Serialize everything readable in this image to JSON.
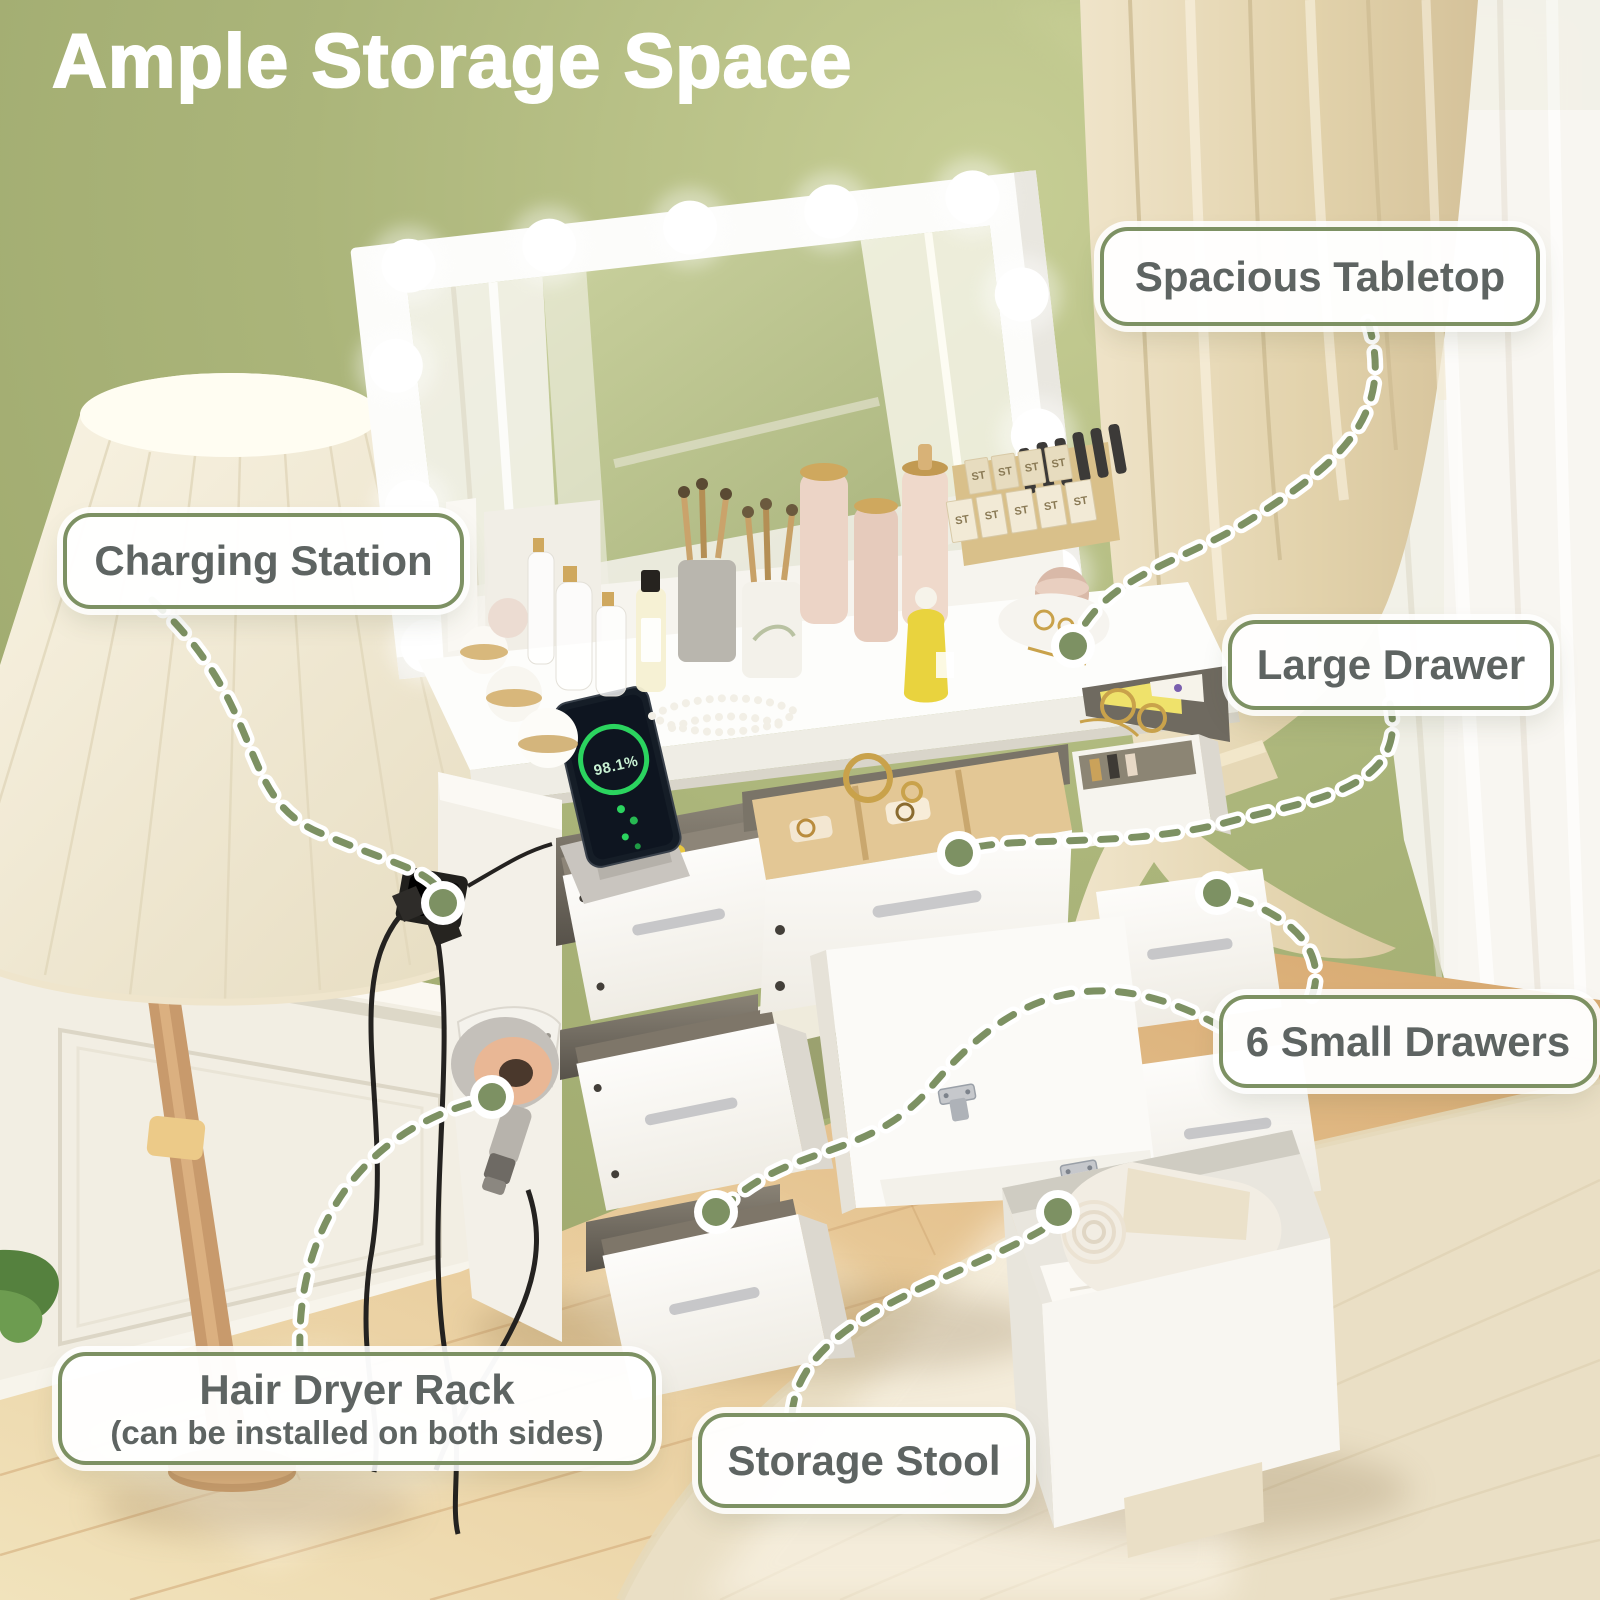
{
  "title": "Ample Storage Space",
  "callouts": {
    "spacious_tabletop": "Spacious Tabletop",
    "charging_station": "Charging Station",
    "large_drawer": "Large Drawer",
    "small_drawers": "6 Small Drawers",
    "hair_dryer_rack": "Hair Dryer Rack",
    "hair_dryer_rack_note": "(can be installed on both sides)",
    "storage_stool": "Storage Stool"
  },
  "scene": {
    "phone_battery": "98.1%",
    "cosmetic_box_label": "ST"
  },
  "colors": {
    "wall_green": "#a9b377",
    "accent_olive": "#7d9163",
    "label_text": "#5e6462",
    "title_text": "#ffffff",
    "furniture_white": "#fbfaf7",
    "floor_wood": "#e7c795",
    "curtain_beige": "#e4d6b4"
  }
}
